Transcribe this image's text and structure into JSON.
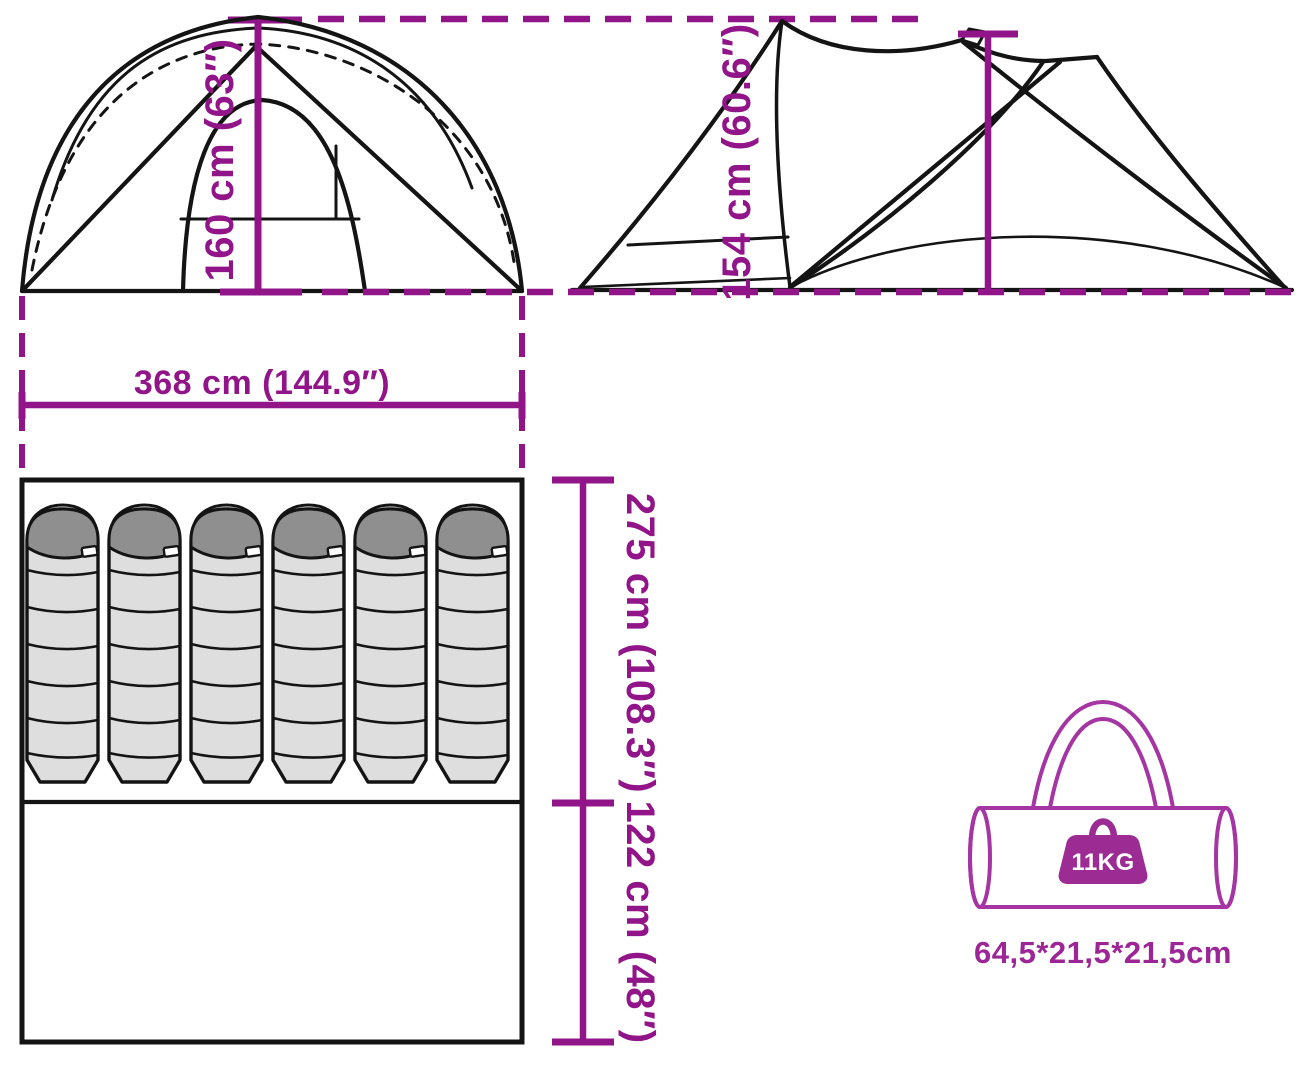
{
  "views": {
    "front_view": {
      "height_label": "160 cm (63″)",
      "width_label": "368 cm (144.9″)"
    },
    "side_view": {
      "height_label": "154 cm (60.6″)"
    },
    "floor_plan": {
      "sleeping_area_label": "275 cm (108.3″)",
      "porch_area_label": "122 cm (48″)",
      "sleeping_bag_count": 6
    },
    "carry_bag": {
      "weight_label": "11KG",
      "size_label": "64,5*21,5*21,5cm"
    }
  },
  "icons": [
    {
      "name": "weight-icon",
      "meaning": "package weight"
    },
    {
      "name": "carry-bag-icon",
      "meaning": "packed tent carry bag"
    },
    {
      "name": "sleeping-bag-icon",
      "meaning": "sleeping berth"
    }
  ],
  "colors": {
    "dimension": "#911489",
    "bag_outline": "#A435A2",
    "weight_fill": "#9D2B94",
    "bag_text": "#9C2696",
    "line": "#141414",
    "bag_body_gray": "#DEDEDE",
    "hood_gray": "#8F8F8F"
  }
}
